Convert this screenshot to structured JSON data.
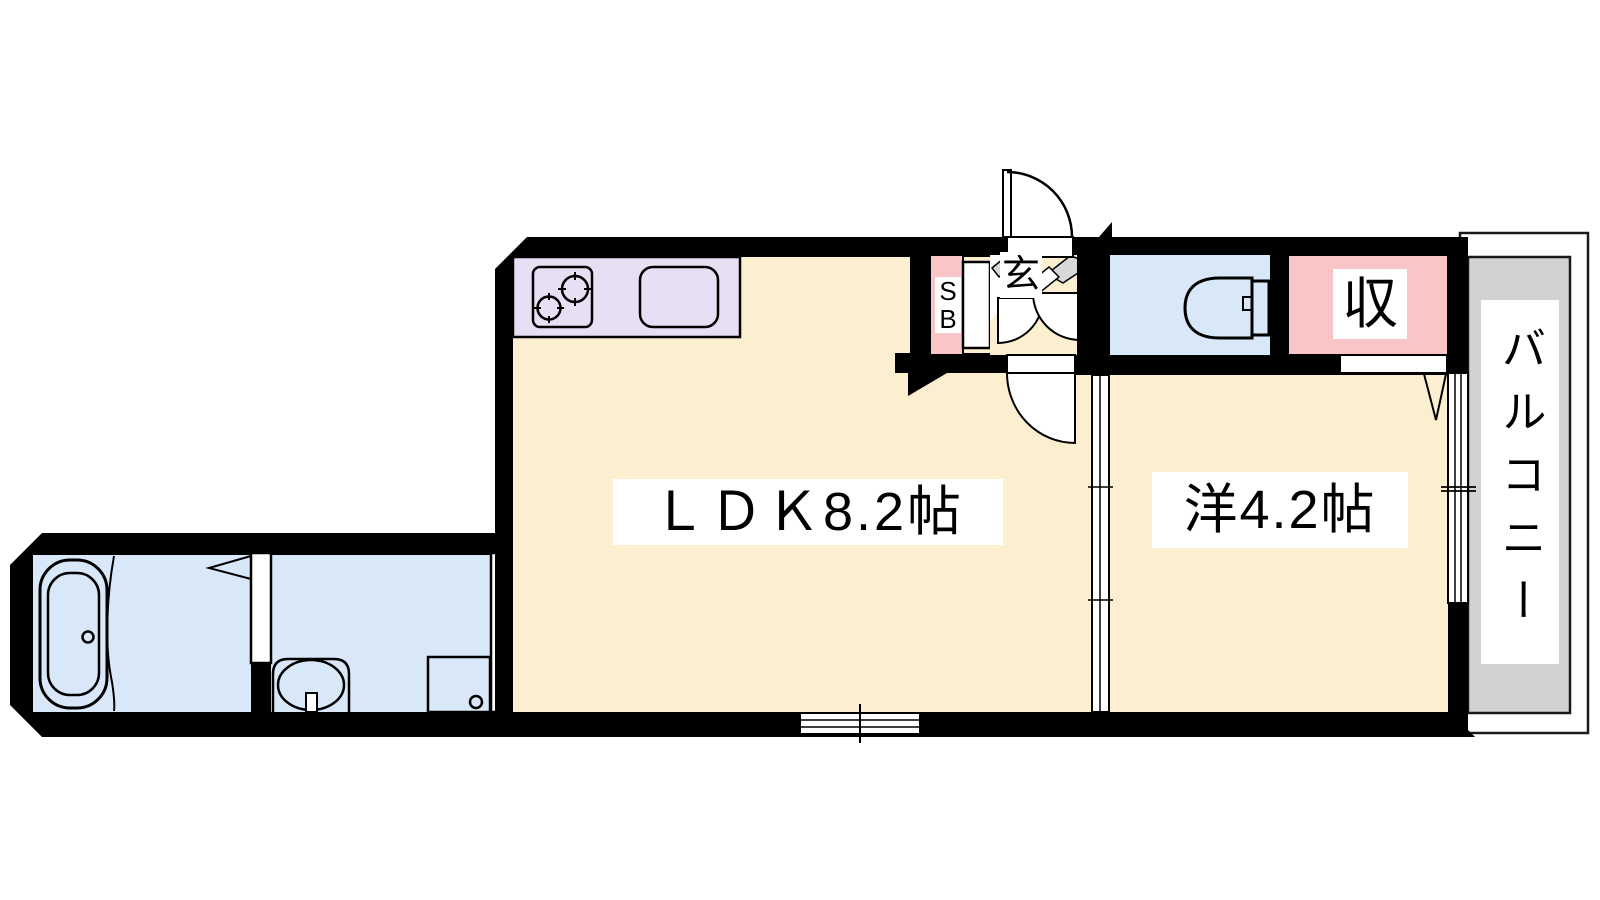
{
  "floorplan": {
    "labels": {
      "ldk": "ＬＤＫ8.2帖",
      "western_room": "洋4.2帖",
      "balcony": "バルコニー",
      "entrance": "玄",
      "closet": "収",
      "shoe_box_line1": "S",
      "shoe_box_line2": "B"
    },
    "colors": {
      "floor": "#FCEFD0",
      "wet_area": "#D9E8F8",
      "storage": "#F9C6C8",
      "kitchen_counter": "#E7DFF3",
      "balcony": "#D2D2D2",
      "step": "#D8D8D8",
      "wall": "#000000"
    }
  }
}
